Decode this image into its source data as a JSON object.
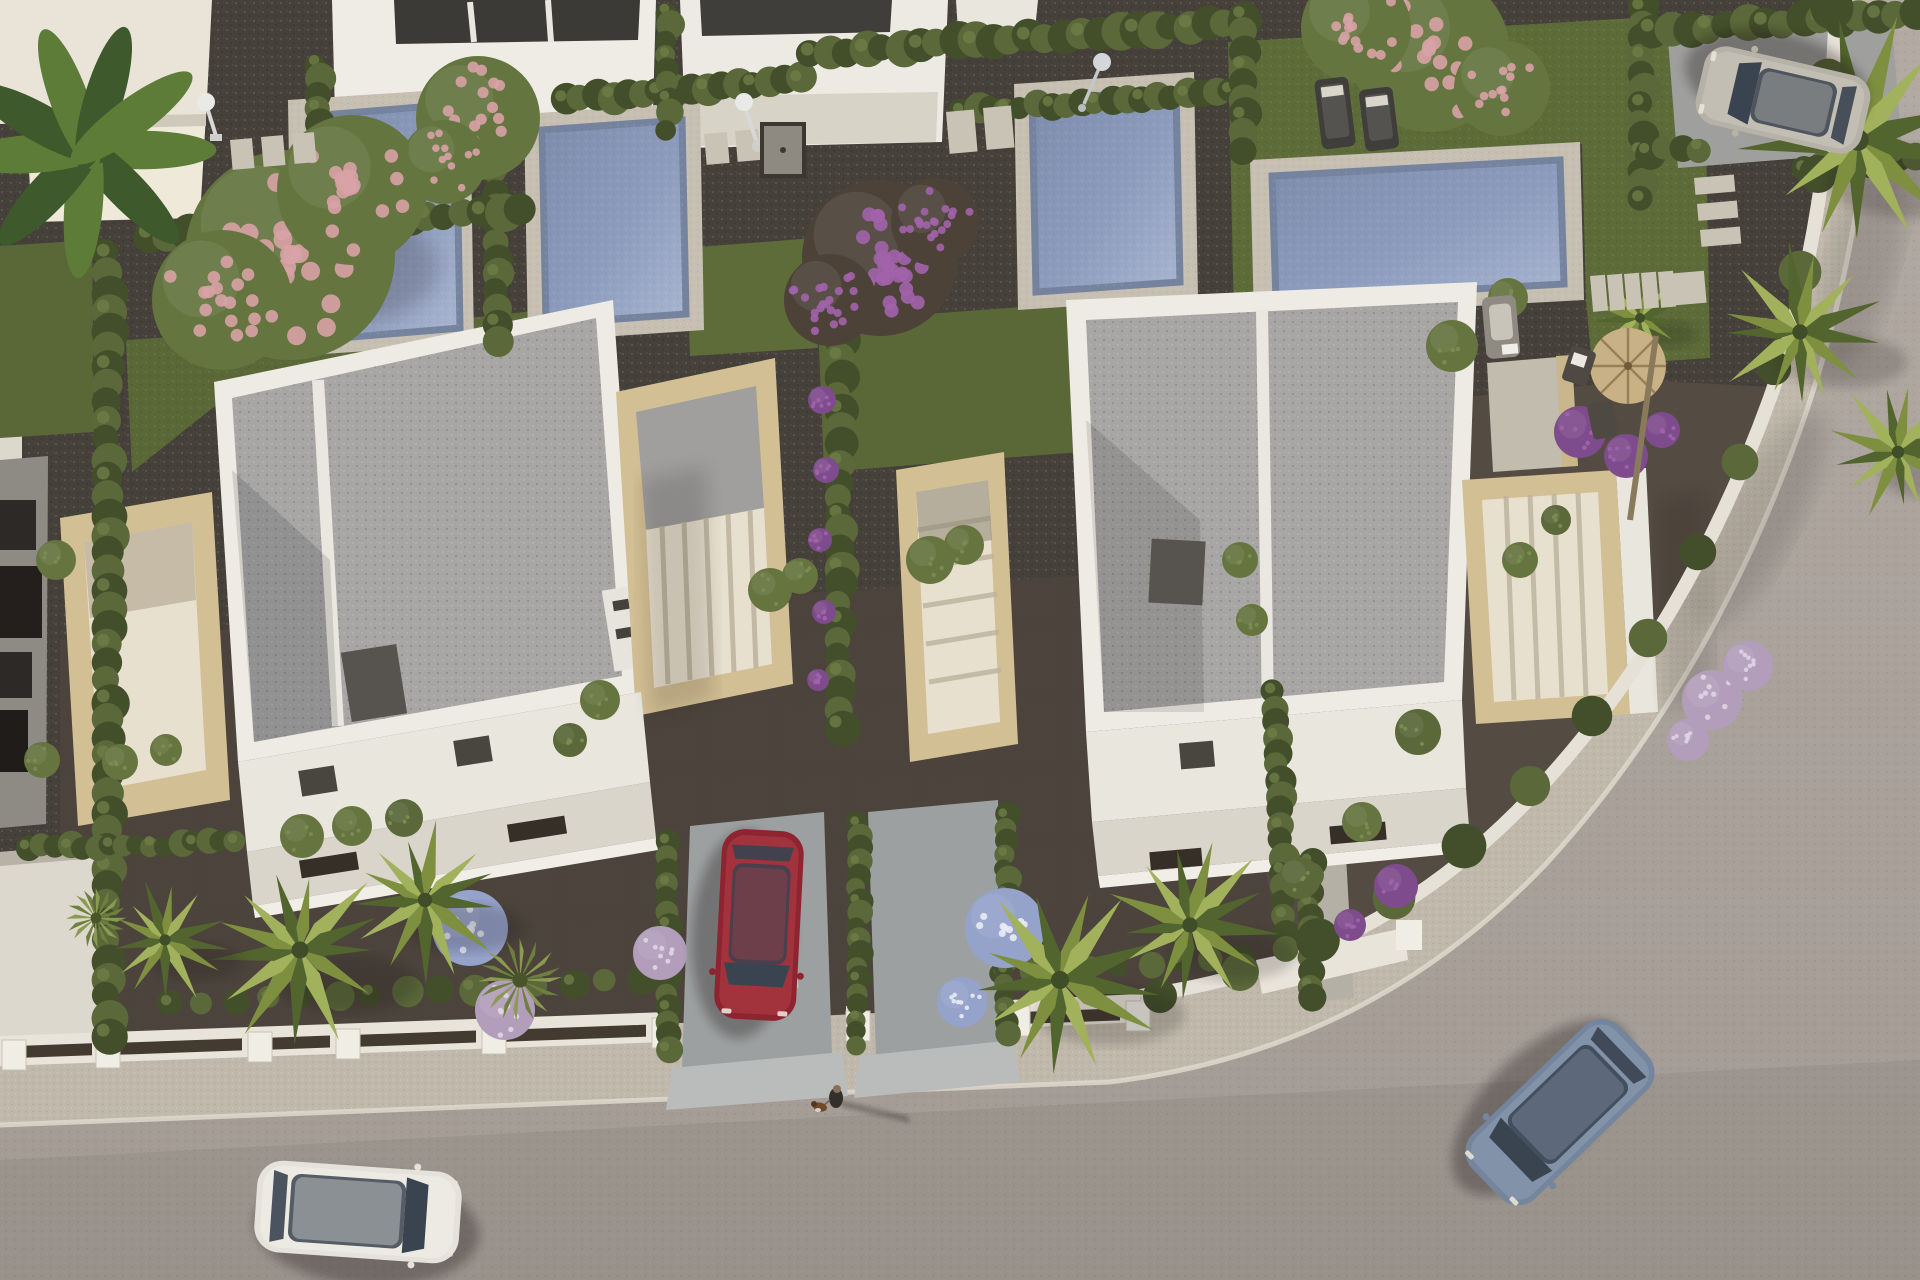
{
  "scene": {
    "type": "aerial-3d-architectural-render",
    "description": "Top-down golden-hour render of a modern villa development: two white flat-roof villas with sandstone terraces, private pools in rear gardens, hedge-divided plots, dark gravel yards with palms and flowering shrubs, a curved street with sidewalk and low white boundary walls, four cars and a pedestrian walking a dog.",
    "lighting": "low warm sun from the west, long soft shadows cast east",
    "visible_text": []
  },
  "colors": {
    "gravel": "#453f38",
    "gravelFront": "#4c453d",
    "gravelRight": "#544c43",
    "road": "#aba39c",
    "roadLow": "#a39b94",
    "sidewalk": "#c0b8ab",
    "curb": "#ded8cd",
    "wallWhite": "#e8e4da",
    "wallShade": "#cfcabf",
    "gateDark": "#443b30",
    "villaWhite": "#edebe3",
    "villaShade": "#d9d5cb",
    "roofGravel": "#a7a6a5",
    "roofShade": "#94938f",
    "sandstone": "#d3bf94",
    "sandstoneShade": "#b39e73",
    "terraceCream": "#e8e0cf",
    "slatShadow": "#bcb29c",
    "poolDeck": "#c6bfb2",
    "poolWater": "#8d9cbe",
    "poolWaterLight": "#b0bbd4",
    "poolRim": "#75839f",
    "lawn": "#5a6837",
    "lawnLight": "#69793f",
    "hedge": "#5a683a",
    "hedgeDark": "#434f2b",
    "palm": "#7e903f",
    "palmLight": "#a2b15c",
    "palmDark": "#53652e",
    "pink": "#d8a2a6",
    "purple": "#7e4c8c",
    "purpleLight": "#a263ab",
    "lilac": "#b29eba",
    "blueFlower": "#95a2ca",
    "chimney": "#57544f",
    "skylight": "#49463f",
    "slotDark": "#362f27",
    "concrete": "#9da0a1",
    "concreteLight": "#b9bcba",
    "carRed": "#8e2430",
    "carRedLight": "#b24049",
    "carBlue": "#74859d",
    "carBlueLight": "#8c9cb2",
    "carWhite": "#e4e2db",
    "carWhiteLight": "#f2f0ea",
    "carSilver": "#b7b2a7",
    "carSilverLight": "#ccc8bd",
    "glass": "#3a4350",
    "glassLight": "#9aa4ae",
    "straw": "#c9b186",
    "strawDark": "#8d764c",
    "wood": "#8a7a5c",
    "trunk": "#8a7a5c",
    "skin": "#8a6f58",
    "clothes": "#332f2a",
    "dog": "#6e4a28",
    "shadow": "#141109"
  },
  "props": {
    "pools": [
      {
        "name": "pool-left",
        "deck": "288,100 470,88 474,344 292,356",
        "water": "312,116 456,104 460,328 316,340"
      },
      {
        "name": "pool-mid",
        "deck": "524,114 700,102 704,330 528,342",
        "water": "542,130 682,120 686,314 546,324"
      },
      {
        "name": "pool-villa2",
        "deck": "1014,84 1194,72 1198,298 1018,310",
        "water": "1032,100 1176,90 1180,282 1036,292"
      },
      {
        "name": "pool-right",
        "deck": "1250,160 1580,142 1584,300 1254,318",
        "water": "1272,176 1560,160 1564,284 1276,300"
      }
    ],
    "sun_loungers": [
      {
        "x": 1318,
        "y": 78,
        "w": 34,
        "h": 70,
        "rot": -7
      },
      {
        "x": 1362,
        "y": 88,
        "w": 34,
        "h": 62,
        "rot": -7
      }
    ],
    "parasol": {
      "cx": 1628,
      "cy": 366,
      "r": 38
    },
    "deck_chairs": [
      {
        "x": 1566,
        "y": 348,
        "rot": 18
      },
      {
        "x": 1590,
        "y": 402,
        "rot": -12
      }
    ],
    "pool_sofa": {
      "x": 1484,
      "y": 296,
      "w": 34,
      "h": 62
    },
    "showers": [
      {
        "x": 206,
        "y": 102
      },
      {
        "x": 744,
        "y": 102
      }
    ],
    "lamp": {
      "x": 1100,
      "y": 62
    },
    "pad_rows": [
      {
        "x": 230,
        "y": 140,
        "w": 22,
        "h": 30,
        "n": 3,
        "dx": 31,
        "dy": -3
      },
      {
        "x": 704,
        "y": 134,
        "w": 23,
        "h": 31,
        "n": 2,
        "dx": 31,
        "dy": -3
      },
      {
        "x": 946,
        "y": 112,
        "w": 28,
        "h": 42,
        "n": 2,
        "dx": 37,
        "dy": -4
      },
      {
        "x": 1590,
        "y": 276,
        "w": 15,
        "h": 36,
        "n": 5,
        "dx": 17,
        "dy": -1
      },
      {
        "x": 1666,
        "y": 274,
        "w": 38,
        "h": 32,
        "n": 1,
        "dx": 0,
        "dy": 0
      },
      {
        "x": 1694,
        "y": 178,
        "w": 40,
        "h": 17,
        "n": 3,
        "dx": 3,
        "dy": 26
      },
      {
        "x": 770,
        "y": 960,
        "w": 26,
        "h": 30,
        "n": 1,
        "dx": 0,
        "dy": 0
      }
    ],
    "shower_mat": {
      "x": 762,
      "y": 124,
      "w": 42,
      "h": 52
    },
    "wall_piers": [
      {
        "x": 2,
        "y": 1040
      },
      {
        "x": 96,
        "y": 1038
      },
      {
        "x": 248,
        "y": 1032
      },
      {
        "x": 336,
        "y": 1029
      },
      {
        "x": 482,
        "y": 1024
      },
      {
        "x": 652,
        "y": 1018
      },
      {
        "x": 846,
        "y": 1011
      },
      {
        "x": 1006,
        "y": 1006
      },
      {
        "x": 1126,
        "y": 1001
      }
    ],
    "wall_caps": [
      {
        "x": 16,
        "y": 1046,
        "w": 76
      },
      {
        "x": 112,
        "y": 1043,
        "w": 130
      },
      {
        "x": 262,
        "y": 1038,
        "w": 68
      },
      {
        "x": 352,
        "y": 1035,
        "w": 124
      },
      {
        "x": 498,
        "y": 1030,
        "w": 148
      },
      {
        "x": 1020,
        "y": 1012,
        "w": 100
      }
    ],
    "person": {
      "x": 836,
      "y": 1094,
      "label": "pedestrian"
    },
    "dog": {
      "x": 820,
      "y": 1106,
      "label": "dog-on-leash"
    }
  },
  "vehicles": [
    {
      "name": "white-hatchback-on-road",
      "x": 358,
      "y": 1212,
      "rot": 4,
      "L": 205,
      "W": 92,
      "body": "carWhite",
      "top": "carWhiteLight"
    },
    {
      "name": "red-car-parked-driveway",
      "x": 759,
      "y": 925,
      "rot": 93,
      "L": 190,
      "W": 82,
      "body": "carRed",
      "top": "carRedLight"
    },
    {
      "name": "blue-sedan-on-road",
      "x": 1560,
      "y": 1112,
      "rot": 136,
      "L": 205,
      "W": 90,
      "body": "carBlue",
      "top": "carBlueLight"
    },
    {
      "name": "silver-hatchback-parked",
      "x": 1783,
      "y": 100,
      "rot": 193,
      "L": 170,
      "W": 80,
      "body": "carSilver",
      "top": "carSilverLight"
    }
  ],
  "vegetation": {
    "hedge_rows": [
      {
        "x1": 108,
        "y1": 255,
        "x2": 108,
        "y2": 1035,
        "r": 16
      },
      {
        "x1": 497,
        "y1": 125,
        "x2": 497,
        "y2": 340,
        "r": 14
      },
      {
        "x1": 150,
        "y1": 236,
        "x2": 520,
        "y2": 210,
        "r": 16
      },
      {
        "x1": 565,
        "y1": 100,
        "x2": 800,
        "y2": 80,
        "r": 14
      },
      {
        "x1": 812,
        "y1": 54,
        "x2": 1244,
        "y2": 22,
        "r": 16
      },
      {
        "x1": 962,
        "y1": 112,
        "x2": 1246,
        "y2": 90,
        "r": 13
      },
      {
        "x1": 318,
        "y1": 64,
        "x2": 318,
        "y2": 168,
        "r": 13
      },
      {
        "x1": 668,
        "y1": 12,
        "x2": 668,
        "y2": 128,
        "r": 12
      },
      {
        "x1": 840,
        "y1": 305,
        "x2": 840,
        "y2": 726,
        "r": 15
      },
      {
        "x1": 1243,
        "y1": 16,
        "x2": 1243,
        "y2": 150,
        "r": 14
      },
      {
        "x1": 1642,
        "y1": 8,
        "x2": 1642,
        "y2": 200,
        "r": 14
      },
      {
        "x1": 1652,
        "y1": 30,
        "x2": 1916,
        "y2": 14,
        "r": 16
      },
      {
        "x1": 1648,
        "y1": 152,
        "x2": 1700,
        "y2": 148,
        "r": 13
      },
      {
        "x1": 1806,
        "y1": 170,
        "x2": 1916,
        "y2": 158,
        "r": 14
      },
      {
        "x1": 170,
        "y1": 1004,
        "x2": 640,
        "y2": 980,
        "r": 13,
        "sp": 2.6
      },
      {
        "x1": 1002,
        "y1": 974,
        "x2": 1240,
        "y2": 958,
        "r": 12,
        "sp": 2.4
      },
      {
        "x1": 668,
        "y1": 842,
        "x2": 668,
        "y2": 1050,
        "r": 12
      },
      {
        "x1": 858,
        "y1": 824,
        "x2": 858,
        "y2": 1044,
        "r": 11
      },
      {
        "x1": 1006,
        "y1": 816,
        "x2": 1006,
        "y2": 1036,
        "r": 11
      },
      {
        "x1": 1274,
        "y1": 692,
        "x2": 1286,
        "y2": 946,
        "r": 13
      },
      {
        "x1": 28,
        "y1": 848,
        "x2": 236,
        "y2": 842,
        "r": 12
      },
      {
        "x1": 1310,
        "y1": 862,
        "x2": 1310,
        "y2": 1000,
        "r": 12
      }
    ],
    "hedge_curve": [
      {
        "x": 1160,
        "y": 996
      },
      {
        "x": 1240,
        "y": 972
      },
      {
        "x": 1318,
        "y": 940
      },
      {
        "x": 1394,
        "y": 898
      },
      {
        "x": 1464,
        "y": 846
      },
      {
        "x": 1530,
        "y": 786
      },
      {
        "x": 1592,
        "y": 716
      },
      {
        "x": 1648,
        "y": 638
      },
      {
        "x": 1698,
        "y": 552
      },
      {
        "x": 1740,
        "y": 462
      },
      {
        "x": 1774,
        "y": 368
      },
      {
        "x": 1800,
        "y": 272
      },
      {
        "x": 1818,
        "y": 174
      },
      {
        "x": 1828,
        "y": 78
      },
      {
        "x": 1832,
        "y": 8
      }
    ],
    "pink_trees": [
      {
        "x": 290,
        "y": 255,
        "r": 105
      },
      {
        "x": 222,
        "y": 300,
        "r": 70
      },
      {
        "x": 352,
        "y": 190,
        "r": 75
      },
      {
        "x": 478,
        "y": 118,
        "r": 62
      },
      {
        "x": 444,
        "y": 162,
        "r": 42
      },
      {
        "x": 1430,
        "y": 52,
        "r": 80
      },
      {
        "x": 1356,
        "y": 28,
        "r": 55
      },
      {
        "x": 1502,
        "y": 88,
        "r": 48
      }
    ],
    "purple_tree": [
      {
        "x": 880,
        "y": 258,
        "r": 78
      },
      {
        "x": 830,
        "y": 300,
        "r": 46
      },
      {
        "x": 935,
        "y": 222,
        "r": 44
      }
    ],
    "purple_clusters": [
      {
        "x": 822,
        "y": 400,
        "r": 14
      },
      {
        "x": 826,
        "y": 470,
        "r": 13
      },
      {
        "x": 820,
        "y": 540,
        "r": 12
      },
      {
        "x": 824,
        "y": 612,
        "r": 12
      },
      {
        "x": 818,
        "y": 680,
        "r": 11
      },
      {
        "x": 1580,
        "y": 432,
        "r": 26
      },
      {
        "x": 1626,
        "y": 456,
        "r": 22
      },
      {
        "x": 1662,
        "y": 430,
        "r": 18
      },
      {
        "x": 1396,
        "y": 886,
        "r": 22
      },
      {
        "x": 1350,
        "y": 925,
        "r": 16
      }
    ],
    "lilac_balls": [
      {
        "x": 505,
        "y": 1010,
        "r": 30
      },
      {
        "x": 660,
        "y": 953,
        "r": 27
      },
      {
        "x": 1712,
        "y": 700,
        "r": 30
      },
      {
        "x": 1748,
        "y": 666,
        "r": 25
      },
      {
        "x": 1688,
        "y": 740,
        "r": 21
      }
    ],
    "blue_flowers": [
      {
        "x": 470,
        "y": 928,
        "r": 38
      },
      {
        "x": 1005,
        "y": 928,
        "r": 40
      },
      {
        "x": 962,
        "y": 1002,
        "r": 25
      }
    ],
    "green_bushes": [
      {
        "x": 120,
        "y": 762,
        "r": 18
      },
      {
        "x": 166,
        "y": 750,
        "r": 16
      },
      {
        "x": 302,
        "y": 836,
        "r": 22
      },
      {
        "x": 352,
        "y": 826,
        "r": 20
      },
      {
        "x": 404,
        "y": 818,
        "r": 19
      },
      {
        "x": 770,
        "y": 590,
        "r": 22
      },
      {
        "x": 800,
        "y": 576,
        "r": 18
      },
      {
        "x": 930,
        "y": 560,
        "r": 24
      },
      {
        "x": 964,
        "y": 545,
        "r": 20
      },
      {
        "x": 56,
        "y": 560,
        "r": 20
      },
      {
        "x": 42,
        "y": 760,
        "r": 18
      },
      {
        "x": 1452,
        "y": 346,
        "r": 26
      },
      {
        "x": 1508,
        "y": 298,
        "r": 20
      },
      {
        "x": 1418,
        "y": 732,
        "r": 23
      },
      {
        "x": 1362,
        "y": 822,
        "r": 20
      },
      {
        "x": 1300,
        "y": 878,
        "r": 21
      },
      {
        "x": 1520,
        "y": 560,
        "r": 18
      },
      {
        "x": 1556,
        "y": 520,
        "r": 15
      },
      {
        "x": 600,
        "y": 700,
        "r": 20
      },
      {
        "x": 570,
        "y": 740,
        "r": 17
      },
      {
        "x": 1240,
        "y": 560,
        "r": 18
      },
      {
        "x": 1252,
        "y": 620,
        "r": 16
      }
    ],
    "yucca": [
      {
        "x": 520,
        "y": 980,
        "r": 42
      },
      {
        "x": 96,
        "y": 918,
        "r": 30
      }
    ],
    "palms": [
      {
        "x": 300,
        "y": 950,
        "r": 95
      },
      {
        "x": 425,
        "y": 900,
        "r": 80
      },
      {
        "x": 165,
        "y": 940,
        "r": 62
      },
      {
        "x": 1060,
        "y": 980,
        "r": 100
      },
      {
        "x": 1190,
        "y": 925,
        "r": 85
      },
      {
        "x": 1858,
        "y": 140,
        "r": 120
      },
      {
        "x": 1800,
        "y": 332,
        "r": 85
      },
      {
        "x": 1898,
        "y": 452,
        "r": 70
      },
      {
        "x": 1640,
        "y": 318,
        "r": 46
      }
    ],
    "banana_palm": {
      "x": 88,
      "y": 150,
      "r": 120
    }
  }
}
